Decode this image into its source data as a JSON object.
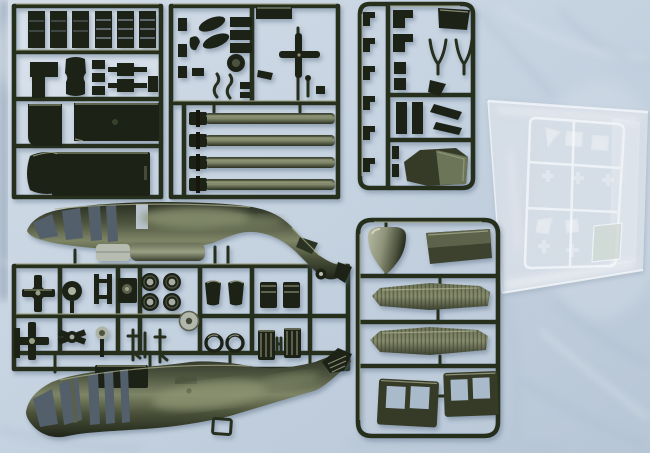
{
  "meta": {
    "title": "Helicopter model kit sprues",
    "caption": "Top-down photograph of an olive-drab UH-60 Black Hawk plastic model kit: three small-part sprues across the top, two large fuselage halves, a wide sprue of rotor-head, wheel and gun parts, a sprue with nose cone, stabilator halves and cabin doors, and a bagged clear-parts sprue, all laid on light blue fabric."
  },
  "colors": {
    "fabric": "#c6d3e1",
    "fabric-hi": "#e2e9f0",
    "fabric-lo": "#a9bacb",
    "fabric-shadow": "#8498ad",
    "sprue-rail": "#272d1f",
    "part-dark": "#1c2217",
    "olive-deep": "#2c3224",
    "olive-mid": "#4e5540",
    "olive-hi": "#8b9172",
    "khaki-glint": "#a9ae8d",
    "metal": "#b7bcb0",
    "opening": "#525e6b",
    "clear-line": "#f2f6fa",
    "bag-tint": "#dae2ea"
  },
  "objects": [
    {
      "id": "fabric-background",
      "label": "Light blue wrinkled fabric background"
    },
    {
      "id": "sprue-a",
      "label": "Sprue A - seat frames, grips, interior floor and roof panels"
    },
    {
      "id": "sprue-b",
      "label": "Sprue B - four main rotor blades, tail rotor, exhausts and small fittings"
    },
    {
      "id": "sprue-c",
      "label": "Sprue C - small detail parts and engine cowling"
    },
    {
      "id": "clear-bag",
      "label": "Bagged clear sprue with cockpit and cabin window parts"
    },
    {
      "id": "fuselage-upper",
      "label": "Fuselage half with tail pylon and tail wheel, nose to the left"
    },
    {
      "id": "sprue-d",
      "label": "Sprue D - rotor head, wheels, machine guns, seats and engine details"
    },
    {
      "id": "fuselage-lower",
      "label": "Second fuselage half with door openings, nose to the left"
    },
    {
      "id": "sprue-e",
      "label": "Sprue E - nose cone, panel, ribbed stabilator halves and two cabin doors"
    }
  ]
}
